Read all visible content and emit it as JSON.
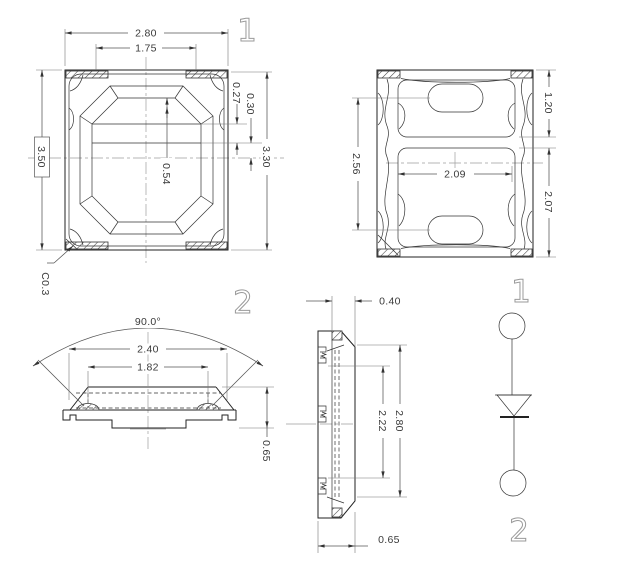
{
  "colors": {
    "background": "#ffffff",
    "body_line": "#222222",
    "dimension_line": "#555555",
    "center_line": "#9e9e9e",
    "marker_digit": "#9a9a9a",
    "text": "#3a3a3a"
  },
  "views": {
    "top": {
      "marker": "1",
      "dim_overall_width": "2.80",
      "dim_opening_width": "1.75",
      "dim_overall_height": "3.50",
      "dim_right_height": "3.30",
      "dim_step_a": "0.30",
      "dim_step_b": "0.27",
      "dim_die_offset": "0.54",
      "chamfer_note": "C0.3"
    },
    "bottom": {
      "dim_top_pad": "1.20",
      "dim_slot_pitch": "2.56",
      "dim_pad_width": "2.09",
      "dim_main_pad": "2.07"
    },
    "front": {
      "marker": "2",
      "dim_view_angle": "90.0°",
      "dim_lens_outer": "2.40",
      "dim_lens_inner": "1.82",
      "dim_thickness": "0.65"
    },
    "side": {
      "dim_lens_height": "0.40",
      "dim_body_length": "2.80",
      "dim_cavity_length": "2.22",
      "dim_thickness": "0.65"
    },
    "circuit": {
      "pin_anode": "1",
      "pin_cathode": "2"
    }
  }
}
